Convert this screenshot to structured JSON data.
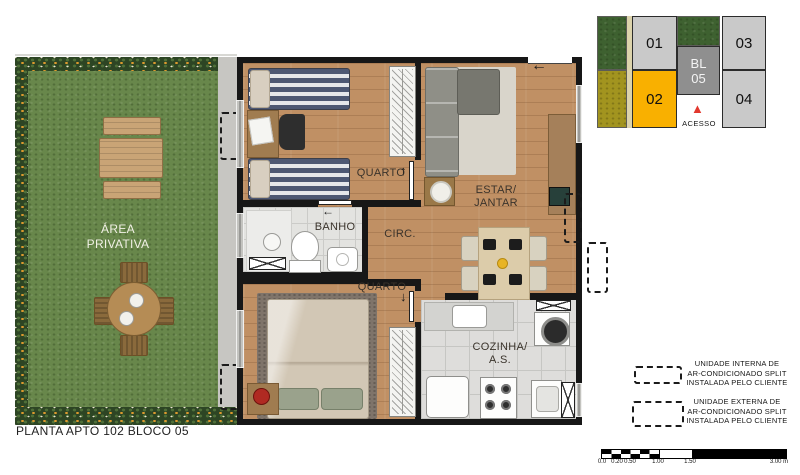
{
  "title": "PLANTA APTO 102 BLOCO 05",
  "garden": {
    "label": [
      "ÁREA",
      "PRIVATIVA"
    ]
  },
  "rooms": {
    "quarto1": "QUARTO",
    "banho": "BANHO",
    "circ": "CIRC.",
    "estar_jantar": [
      "ESTAR/",
      "JANTAR"
    ],
    "quarto2": "QUARTO",
    "cozinha_as": [
      "COZINHA/",
      "A.S."
    ]
  },
  "keyplan": {
    "units": [
      "01",
      "02",
      "03",
      "04"
    ],
    "block": [
      "BL",
      "05"
    ],
    "access": "ACESSO",
    "colors": {
      "unit_default": "#C9C9C9",
      "unit_highlight": "#F9B000",
      "block_core": "#8F8F8F",
      "access_marker": "#E2382E"
    }
  },
  "legend": {
    "internal": [
      "UNIDADE INTERNA DE",
      "AR-CONDICIONADO SPLIT",
      "INSTALADA PELO CLIENTE"
    ],
    "external": [
      "UNIDADE EXTERNA DE",
      "AR-CONDICIONADO SPLIT",
      "INSTALADA PELO CLIENTE"
    ]
  },
  "scalebar": {
    "ticks": [
      "0.0",
      "0.20",
      "0.50",
      "1.00",
      "1.50",
      "3.00 m"
    ]
  },
  "icons": {
    "entry_arrow": "←",
    "door_up_arrow": "↑",
    "door_down_arrow": "↓",
    "door_left_arrow": "←",
    "access_triangle": "▲"
  }
}
